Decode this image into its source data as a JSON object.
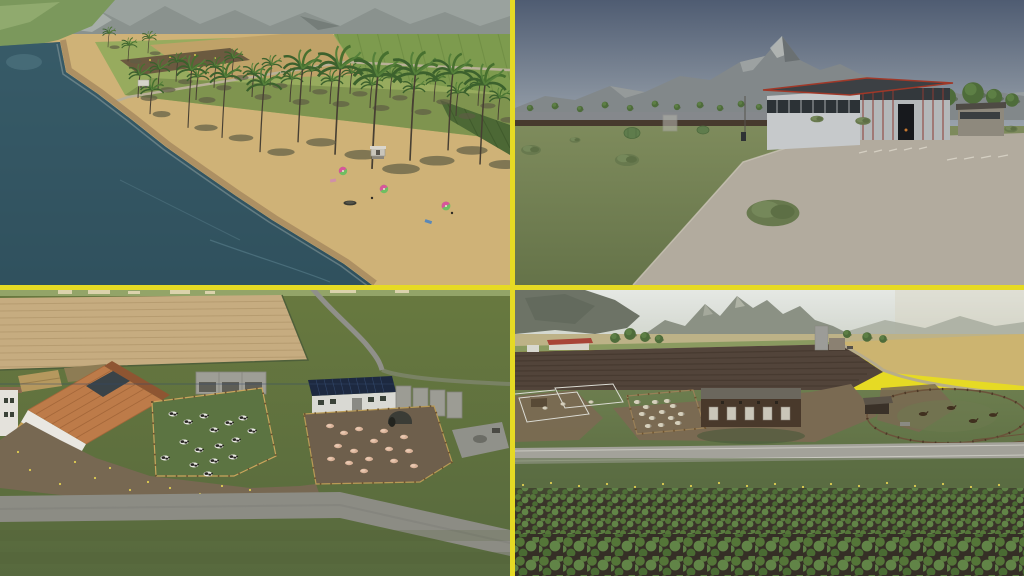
{
  "colors": {
    "divider": "#e6da24",
    "beach_water": "#33525e",
    "beach_sand": "#cfb277",
    "concrete": "#b2ab9e",
    "plow_tan": "#c6ac80",
    "mud": "#776852",
    "road_gray": "#8c8c84",
    "wheat": "#ccb470",
    "plow_dark": "#52443a"
  },
  "stamps": {
    "beach_palms": [
      [
        138,
        96,
        1.0
      ],
      [
        158,
        88,
        0.9
      ],
      [
        176,
        80,
        0.85
      ],
      [
        196,
        98,
        1.0
      ],
      [
        214,
        86,
        0.9
      ],
      [
        232,
        76,
        0.85
      ],
      [
        252,
        95,
        1.0
      ],
      [
        270,
        84,
        0.9
      ],
      [
        290,
        100,
        1.0
      ],
      [
        310,
        90,
        0.9
      ],
      [
        330,
        102,
        1.0
      ],
      [
        350,
        92,
        0.9
      ],
      [
        370,
        106,
        1.0
      ],
      [
        390,
        96,
        0.9
      ],
      [
        412,
        110,
        1.0
      ],
      [
        434,
        100,
        0.9
      ],
      [
        456,
        114,
        1.0
      ],
      [
        478,
        104,
        0.9
      ],
      [
        498,
        118,
        0.95
      ],
      [
        150,
        112,
        1.05
      ],
      [
        128,
        60,
        0.7
      ],
      [
        148,
        52,
        0.65
      ],
      [
        108,
        46,
        0.6
      ]
    ],
    "beach_tall_palms": [
      [
        335,
        152,
        1.35
      ],
      [
        372,
        166,
        1.45
      ],
      [
        410,
        158,
        1.35
      ],
      [
        448,
        148,
        1.2
      ],
      [
        480,
        162,
        1.25
      ],
      [
        298,
        140,
        1.15
      ],
      [
        260,
        150,
        1.05
      ],
      [
        222,
        136,
        0.95
      ],
      [
        188,
        126,
        0.9
      ]
    ],
    "beach_umbrellas": [
      [
        343,
        171,
        1
      ],
      [
        384,
        189,
        1
      ],
      [
        446,
        206,
        1.05
      ]
    ],
    "farm_trees_small": [
      [
        15,
        108,
        0.7
      ],
      [
        40,
        106,
        0.75
      ],
      [
        65,
        109,
        0.7
      ],
      [
        90,
        105,
        0.75
      ],
      [
        115,
        108,
        0.7
      ],
      [
        140,
        104,
        0.75
      ],
      [
        162,
        107,
        0.7
      ],
      [
        185,
        105,
        0.75
      ],
      [
        205,
        108,
        0.7
      ],
      [
        226,
        104,
        0.75
      ],
      [
        244,
        107,
        0.7
      ],
      [
        256,
        103,
        0.9
      ],
      [
        272,
        101,
        1
      ],
      [
        289,
        104,
        0.85
      ]
    ],
    "farm_trees_big": [
      [
        432,
        97,
        2.0
      ],
      [
        458,
        93,
        2.4
      ],
      [
        479,
        97,
        1.8
      ],
      [
        497,
        100,
        1.5
      ]
    ],
    "farm_bushes": [
      [
        258,
        213,
        2.4
      ],
      [
        112,
        160,
        1.1
      ],
      [
        16,
        150,
        0.9
      ],
      [
        348,
        121,
        0.7
      ],
      [
        302,
        119,
        0.6
      ],
      [
        496,
        129,
        0.6
      ],
      [
        60,
        140,
        0.5
      ]
    ],
    "cows": [
      [
        173,
        124
      ],
      [
        188,
        132
      ],
      [
        204,
        126
      ],
      [
        214,
        140
      ],
      [
        229,
        133
      ],
      [
        243,
        128
      ],
      [
        252,
        141
      ],
      [
        184,
        152
      ],
      [
        199,
        160
      ],
      [
        219,
        156
      ],
      [
        236,
        150
      ],
      [
        165,
        168
      ],
      [
        194,
        175
      ],
      [
        214,
        171
      ],
      [
        233,
        167
      ],
      [
        208,
        184
      ]
    ],
    "pigs": [
      [
        330,
        136
      ],
      [
        344,
        143
      ],
      [
        359,
        139
      ],
      [
        338,
        156
      ],
      [
        354,
        161
      ],
      [
        374,
        151
      ],
      [
        389,
        159
      ],
      [
        369,
        169
      ],
      [
        349,
        173
      ],
      [
        394,
        171
      ],
      [
        409,
        161
      ],
      [
        331,
        169
      ],
      [
        384,
        141
      ],
      [
        404,
        147
      ],
      [
        364,
        181
      ],
      [
        414,
        176
      ]
    ],
    "barn_flowers": [
      [
        30,
        180
      ],
      [
        60,
        194
      ],
      [
        95,
        188
      ],
      [
        130,
        200
      ],
      [
        170,
        198
      ],
      [
        200,
        204
      ],
      [
        230,
        206
      ],
      [
        18,
        162
      ],
      [
        250,
        200
      ],
      [
        75,
        172
      ],
      [
        110,
        178
      ],
      [
        148,
        192
      ],
      [
        185,
        206
      ],
      [
        222,
        196
      ],
      [
        320,
        204
      ],
      [
        360,
        208
      ]
    ],
    "sheep": [
      [
        122,
        112
      ],
      [
        131,
        117
      ],
      [
        140,
        112
      ],
      [
        127,
        124
      ],
      [
        137,
        128
      ],
      [
        147,
        122
      ],
      [
        156,
        128
      ],
      [
        146,
        135
      ],
      [
        133,
        136
      ],
      [
        158,
        116
      ],
      [
        166,
        124
      ],
      [
        152,
        111
      ],
      [
        163,
        133
      ]
    ],
    "pen_animals": [
      [
        30,
        118,
        0.8
      ],
      [
        48,
        114,
        0.8
      ],
      [
        76,
        112,
        0.8
      ]
    ],
    "horses": [
      [
        408,
        124,
        1
      ],
      [
        436,
        118,
        1
      ],
      [
        458,
        131,
        1
      ],
      [
        478,
        125,
        0.95
      ]
    ],
    "pasture_trees": [
      [
        100,
        48,
        1.1
      ],
      [
        115,
        44,
        1.3
      ],
      [
        130,
        47,
        1.1
      ],
      [
        144,
        49,
        0.95
      ],
      [
        332,
        44,
        0.9
      ],
      [
        352,
        47,
        1.05
      ],
      [
        368,
        49,
        0.85
      ]
    ],
    "pasture_flowers": [
      [
        8,
        195
      ],
      [
        36,
        193
      ],
      [
        64,
        196
      ],
      [
        92,
        194
      ],
      [
        120,
        197
      ],
      [
        148,
        194
      ],
      [
        176,
        196
      ],
      [
        204,
        193
      ],
      [
        232,
        196
      ],
      [
        260,
        194
      ],
      [
        288,
        197
      ],
      [
        316,
        194
      ],
      [
        344,
        196
      ],
      [
        372,
        193
      ],
      [
        400,
        196
      ],
      [
        428,
        194
      ],
      [
        456,
        197
      ],
      [
        484,
        195
      ]
    ]
  }
}
